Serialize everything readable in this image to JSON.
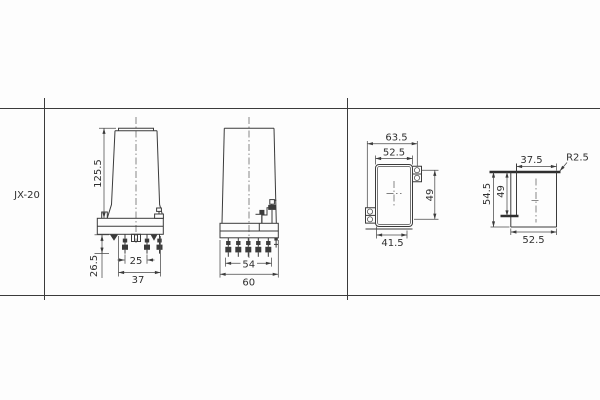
{
  "model": {
    "label": "JX-20"
  },
  "colors": {
    "line": "#3b3b3b",
    "text": "#2f2f2f",
    "background": "#fdfdfd"
  },
  "views": {
    "side": {
      "height": "125.5",
      "pin_length": "26.5",
      "pin_spacing": "25",
      "depth": "37"
    },
    "front": {
      "pin_row_width": "54",
      "width": "60"
    },
    "cutout_front": {
      "overall_width": "63.5",
      "opening_width": "52.5",
      "height": "49",
      "lower_width": "41.5"
    },
    "cutout_side": {
      "upper_width": "37.5",
      "corner_radius": "R2.5",
      "overall_height": "54.5",
      "opening_height": "49",
      "lower_width": "52.5"
    }
  }
}
